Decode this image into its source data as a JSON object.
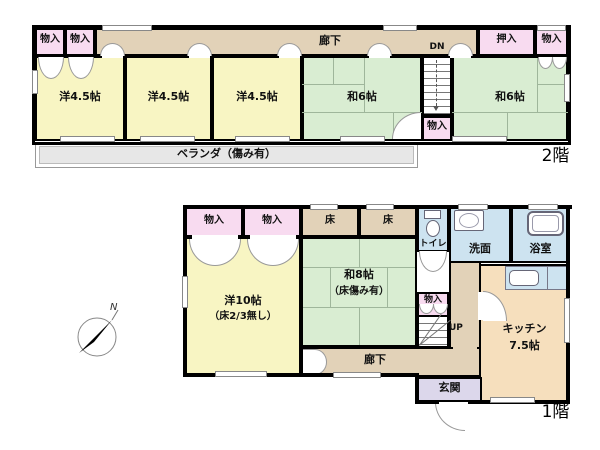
{
  "floor2": {
    "floor_label": "2階",
    "closet_left_a": "物入",
    "closet_left_b": "物入",
    "corridor": "廊下",
    "stairs_dn": "DN",
    "room_west_a": "洋4.5帖",
    "room_west_b": "洋4.5帖",
    "room_west_c": "洋4.5帖",
    "room_jpn_a": "和6帖",
    "room_jpn_b": "和6帖",
    "closet_oshiire": "押入",
    "closet_right": "物入",
    "closet_stairs": "物入",
    "veranda": "ベランダ（傷み有）"
  },
  "floor1": {
    "floor_label": "1階",
    "closet_a": "物入",
    "closet_b": "物入",
    "toko_a": "床",
    "toko_b": "床",
    "toilet": "トイレ",
    "washroom": "洗面",
    "bathroom": "浴室",
    "room_west": "洋10帖",
    "room_west_note": "（床2/3無し）",
    "room_jpn": "和8帖",
    "room_jpn_note": "（床傷み有）",
    "closet_stairs": "物入",
    "stairs_up": "UP",
    "kitchen": "キッチン",
    "kitchen_size": "7.5帖",
    "corridor": "廊下",
    "entrance": "玄関"
  },
  "compass": {
    "north": "N"
  },
  "colors": {
    "wall": "#000000",
    "western_room": "#f8f5c3",
    "japanese_room": "#d9edd2",
    "closet": "#f8dbf0",
    "corridor": "#e2d2b8",
    "wet_area": "#cde3f0",
    "kitchen": "#f6dfbd",
    "entrance": "#dcd7eb",
    "veranda": "#e7e7e7"
  }
}
